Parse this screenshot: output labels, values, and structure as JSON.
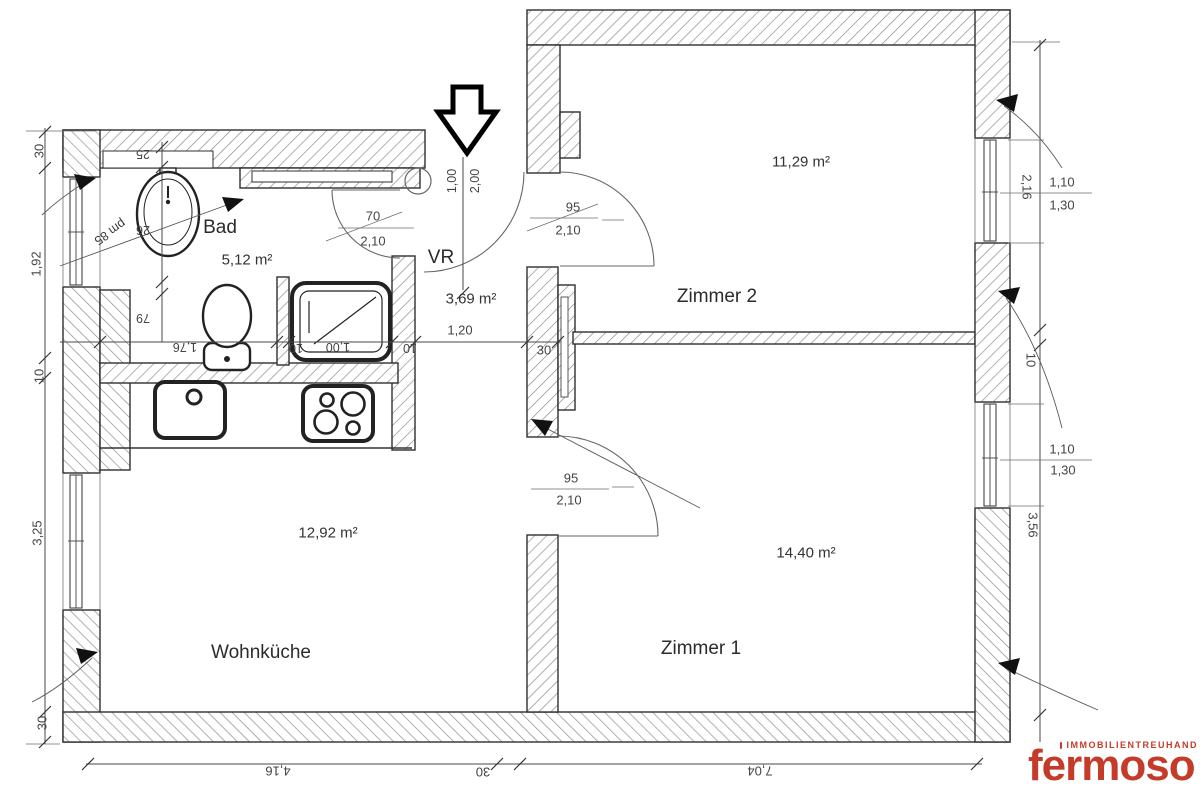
{
  "rooms": {
    "bad": {
      "name": "Bad",
      "area": "5,12 m²"
    },
    "vr": {
      "name": "VR",
      "area": "3,69 m²"
    },
    "zimmer2": {
      "name": "Zimmer 2",
      "area": "11,29 m²"
    },
    "zimmer1": {
      "name": "Zimmer 1",
      "area": "14,40 m²"
    },
    "wohnkueche": {
      "name": "Wohnküche",
      "area": "12,92 m²"
    }
  },
  "doors": {
    "bad": {
      "width": "70",
      "height": "2,10"
    },
    "zimmer2": {
      "width": "95",
      "height": "2,10"
    },
    "zimmer1": {
      "width": "95",
      "height": "2,10"
    },
    "entrance": {
      "width": "1,00",
      "height": "2,00"
    }
  },
  "dims": {
    "vr": {
      "width": "1,20",
      "wall": "30"
    },
    "bottom": {
      "seg1": "4,16",
      "wall": "30",
      "seg2": "7,04"
    },
    "left": {
      "wall_top": "30",
      "seg1": "1,92",
      "wall_mid": "10",
      "seg2": "3,25",
      "wall_bottom": "30"
    },
    "right": {
      "seg1": "2,16",
      "win1_height": "1,10",
      "win1_opening": "1,30",
      "wall_mid": "10",
      "seg2": "3,56",
      "win2_height": "1,10",
      "win2_opening": "1,30"
    },
    "bad": {
      "v1": "25",
      "v2": "26",
      "v3": "79",
      "note": "pm 85",
      "h1": "1,76",
      "h2": "10",
      "h3": "1,00",
      "h4": "10"
    }
  },
  "logo": {
    "brand": "fermoso",
    "tagline": "IMMOBILIENTREUHAND"
  },
  "colors": {
    "logo_red": "#c43b2a",
    "wall_line": "#2f2f2f",
    "hatch": "#8f8f8f"
  }
}
